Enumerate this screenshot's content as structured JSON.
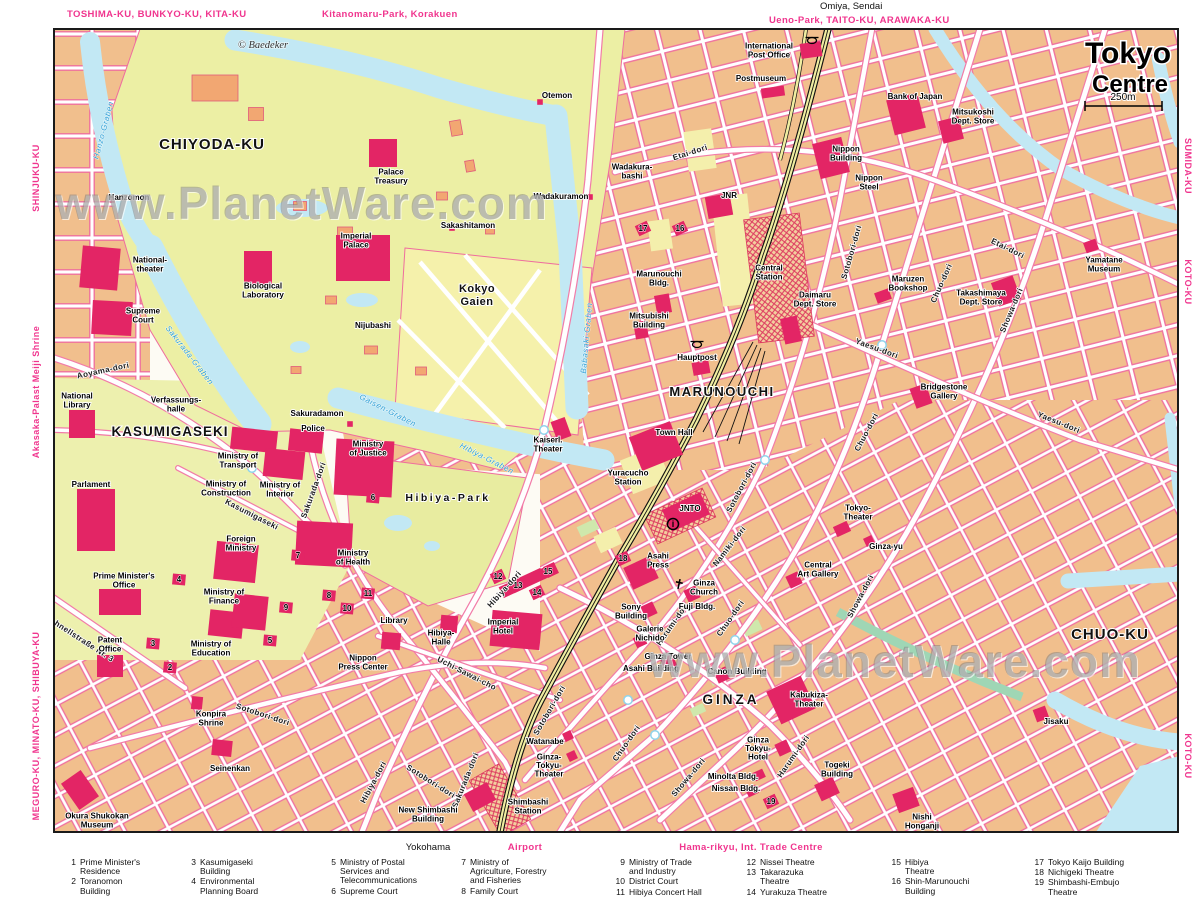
{
  "header": {
    "top_labels": [
      {
        "text": "TOSHIMA-KU, BUNKYO-KU, KITA-KU",
        "color": "pink"
      },
      {
        "text": "Kitanomaru-Park, Korakuen",
        "color": "pink"
      },
      {
        "text": "Omiya, Sendai",
        "color": "black"
      },
      {
        "text": "Ueno-Park, TAITO-KU, ARAWAKA-KU",
        "color": "pink"
      }
    ]
  },
  "title": {
    "line1": "Tokyo",
    "line2": "Centre",
    "scale_label": "250m"
  },
  "copyright": "© Baedeker",
  "watermark": {
    "text": "www.PlanetWare.com"
  },
  "edges": {
    "left": [
      {
        "text": "SHINJUKU-KU"
      },
      {
        "text": "Akasaka-Palast  Meiji Shrine"
      },
      {
        "text": "MEGURO-KU, MINATO-KU, SHIBUYA-KU"
      }
    ],
    "right": [
      {
        "text": "SUMIDA-KU"
      },
      {
        "text": "KOTO-KU"
      },
      {
        "text": "KOTO-KU"
      }
    ]
  },
  "footer": {
    "labels": [
      {
        "text": "Yokohama",
        "color": "black"
      },
      {
        "text": "Airport",
        "color": "pink"
      },
      {
        "text": "Hama-rikyu, Int. Trade Centre",
        "color": "pink"
      }
    ]
  },
  "map": {
    "districts": [
      {
        "t": "CHIYODA-KU",
        "x": 212,
        "y": 146,
        "fs": 15,
        "ls": 1
      },
      {
        "t": "KASUMIGASEKI",
        "x": 170,
        "y": 433,
        "fs": 13.5,
        "ls": 1
      },
      {
        "t": "MARUNOUCHI",
        "x": 722,
        "y": 393,
        "fs": 13,
        "ls": 1.5
      },
      {
        "t": "GINZA",
        "x": 731,
        "y": 701,
        "fs": 13.5,
        "ls": 3
      },
      {
        "t": "CHUO-KU",
        "x": 1110,
        "y": 636,
        "fs": 15,
        "ls": 1
      },
      {
        "t": "Kokyo",
        "x": 477,
        "y": 289,
        "fs": 11,
        "ls": 0.5
      },
      {
        "t": "Gaien",
        "x": 477,
        "y": 302,
        "fs": 11,
        "ls": 0.5
      },
      {
        "t": "Hibiya-Park",
        "x": 448,
        "y": 498,
        "fs": 10.5,
        "ls": 2.5
      }
    ],
    "street_labels": [
      {
        "t": "Aoyama-dori",
        "x": 103,
        "y": 370,
        "r": -12
      },
      {
        "t": "Kasumigaseki",
        "x": 252,
        "y": 514,
        "r": 27
      },
      {
        "t": "Sakurada-dori",
        "x": 313,
        "y": 490,
        "r": -70
      },
      {
        "t": "Sakurada-dori",
        "x": 465,
        "y": 780,
        "r": -68
      },
      {
        "t": "Hibiya-dori",
        "x": 504,
        "y": 589,
        "r": -48
      },
      {
        "t": "Hibiya-dori",
        "x": 373,
        "y": 782,
        "r": -62
      },
      {
        "t": "Uchi-Sawai-cho",
        "x": 467,
        "y": 673,
        "r": 27
      },
      {
        "t": "Sotobori-dori",
        "x": 851,
        "y": 252,
        "r": -74
      },
      {
        "t": "Sotobori-dori",
        "x": 741,
        "y": 487,
        "r": -62
      },
      {
        "t": "Sotobori-dori",
        "x": 263,
        "y": 714,
        "r": 18
      },
      {
        "t": "Sotobori-dori",
        "x": 431,
        "y": 781,
        "r": 32
      },
      {
        "t": "Sotobori-dori",
        "x": 549,
        "y": 710,
        "r": -60
      },
      {
        "t": "Namiki-dori",
        "x": 729,
        "y": 546,
        "r": -52
      },
      {
        "t": "Chuo-dori",
        "x": 941,
        "y": 283,
        "r": -66
      },
      {
        "t": "Chuo-dori",
        "x": 866,
        "y": 432,
        "r": -62
      },
      {
        "t": "Chuo-dori",
        "x": 730,
        "y": 618,
        "r": -55
      },
      {
        "t": "Chuo-dori",
        "x": 626,
        "y": 743,
        "r": -55
      },
      {
        "t": "Showa-dori",
        "x": 1011,
        "y": 310,
        "r": -67
      },
      {
        "t": "Showa-dori",
        "x": 860,
        "y": 596,
        "r": -62
      },
      {
        "t": "Showa-dori",
        "x": 688,
        "y": 777,
        "r": -50
      },
      {
        "t": "Harumi-dori",
        "x": 672,
        "y": 624,
        "r": -55
      },
      {
        "t": "Harumi-dori",
        "x": 793,
        "y": 756,
        "r": -55
      },
      {
        "t": "Yaesu-dori",
        "x": 877,
        "y": 348,
        "r": 20
      },
      {
        "t": "Yaesu-dori",
        "x": 1059,
        "y": 422,
        "r": 22
      },
      {
        "t": "Etai-dori",
        "x": 690,
        "y": 152,
        "r": -18
      },
      {
        "t": "Etai-dori",
        "x": 1008,
        "y": 248,
        "r": 26
      },
      {
        "t": "Schnellstraße Nr. 3",
        "x": 80,
        "y": 638,
        "r": 33
      }
    ],
    "water_labels": [
      {
        "t": "Hanzo-Graben",
        "x": 103,
        "y": 130,
        "r": -75
      },
      {
        "t": "Sakurada-Graben",
        "x": 190,
        "y": 355,
        "r": 52
      },
      {
        "t": "Babasaki-Graben",
        "x": 586,
        "y": 338,
        "r": -85
      },
      {
        "t": "Gaisen-Graben",
        "x": 388,
        "y": 410,
        "r": 27
      },
      {
        "t": "Hibiya-Graben",
        "x": 487,
        "y": 458,
        "r": 27
      }
    ],
    "landmarks": [
      {
        "x": 150,
        "y": 264,
        "l": [
          "National-",
          "theater"
        ]
      },
      {
        "x": 143,
        "y": 315,
        "l": [
          "Supreme",
          "Court"
        ]
      },
      {
        "x": 77,
        "y": 400,
        "l": [
          "National",
          "Library"
        ]
      },
      {
        "x": 176,
        "y": 404,
        "l": [
          "Verfassungs-",
          "halle"
        ]
      },
      {
        "x": 91,
        "y": 484,
        "l": [
          "Parlament"
        ]
      },
      {
        "x": 124,
        "y": 580,
        "l": [
          "Prime Minister's",
          "Office"
        ]
      },
      {
        "x": 110,
        "y": 644,
        "l": [
          "Patent",
          "Office"
        ]
      },
      {
        "x": 97,
        "y": 820,
        "l": [
          "Okura Shukokan",
          "Museum"
        ]
      },
      {
        "x": 230,
        "y": 768,
        "l": [
          "Seinenkan"
        ]
      },
      {
        "x": 211,
        "y": 718,
        "l": [
          "Konpira",
          "Shrine"
        ]
      },
      {
        "x": 211,
        "y": 648,
        "l": [
          "Ministry of",
          "Education"
        ]
      },
      {
        "x": 224,
        "y": 596,
        "l": [
          "Ministry of",
          "Finance"
        ]
      },
      {
        "x": 238,
        "y": 460,
        "l": [
          "Ministry of",
          "Transport"
        ]
      },
      {
        "x": 226,
        "y": 488,
        "l": [
          "Ministry of",
          "Construction"
        ]
      },
      {
        "x": 280,
        "y": 489,
        "l": [
          "Ministry of",
          "Interior"
        ]
      },
      {
        "x": 241,
        "y": 543,
        "l": [
          "Foreign",
          "Ministry"
        ]
      },
      {
        "x": 353,
        "y": 557,
        "l": [
          "Ministry",
          "of Health"
        ]
      },
      {
        "x": 313,
        "y": 428,
        "l": [
          "Police"
        ]
      },
      {
        "x": 368,
        "y": 448,
        "l": [
          "Ministry",
          "of Justice"
        ]
      },
      {
        "x": 394,
        "y": 620,
        "l": [
          "Library"
        ]
      },
      {
        "x": 363,
        "y": 662,
        "l": [
          "Nippon",
          "Press Center"
        ]
      },
      {
        "x": 441,
        "y": 637,
        "l": [
          "Hibiya-",
          "Halle"
        ]
      },
      {
        "x": 503,
        "y": 626,
        "l": [
          "Imperial",
          "Hotel"
        ]
      },
      {
        "x": 263,
        "y": 290,
        "l": [
          "Biological",
          "Laboratory"
        ]
      },
      {
        "x": 356,
        "y": 240,
        "l": [
          "Imperial",
          "Palace"
        ]
      },
      {
        "x": 391,
        "y": 176,
        "l": [
          "Palace",
          "Treasury"
        ]
      },
      {
        "x": 129,
        "y": 197,
        "l": [
          "Hanzomon"
        ]
      },
      {
        "x": 557,
        "y": 95,
        "l": [
          "Otemon"
        ]
      },
      {
        "x": 561,
        "y": 196,
        "l": [
          "Wadakuramon"
        ]
      },
      {
        "x": 468,
        "y": 225,
        "l": [
          "Sakashitamon"
        ]
      },
      {
        "x": 632,
        "y": 171,
        "l": [
          "Wadakura-",
          "bashi"
        ]
      },
      {
        "x": 373,
        "y": 325,
        "l": [
          "Nijubashi"
        ]
      },
      {
        "x": 317,
        "y": 413,
        "l": [
          "Sakuradamon"
        ]
      },
      {
        "x": 548,
        "y": 444,
        "l": [
          "Kaiserl.",
          "Theater"
        ]
      },
      {
        "x": 674,
        "y": 432,
        "l": [
          "Town Hall"
        ]
      },
      {
        "x": 628,
        "y": 477,
        "l": [
          "Yuracucho",
          "Station"
        ]
      },
      {
        "x": 690,
        "y": 508,
        "l": [
          "JNTO"
        ]
      },
      {
        "x": 658,
        "y": 560,
        "l": [
          "Asahi",
          "Press"
        ]
      },
      {
        "x": 704,
        "y": 587,
        "l": [
          "Ginza",
          "Church"
        ]
      },
      {
        "x": 631,
        "y": 611,
        "l": [
          "Sony",
          "Building"
        ]
      },
      {
        "x": 697,
        "y": 606,
        "l": [
          "Fuji Bldg."
        ]
      },
      {
        "x": 650,
        "y": 633,
        "l": [
          "Galerie",
          "Nichido"
        ]
      },
      {
        "x": 668,
        "y": 656,
        "l": [
          "Ginza Tower"
        ]
      },
      {
        "x": 651,
        "y": 668,
        "l": [
          "Asahi Building"
        ]
      },
      {
        "x": 737,
        "y": 671,
        "l": [
          "Canon Building"
        ]
      },
      {
        "x": 818,
        "y": 569,
        "l": [
          "Central",
          "Art Gallery"
        ]
      },
      {
        "x": 858,
        "y": 512,
        "l": [
          "Tokyo-",
          "Theater"
        ]
      },
      {
        "x": 886,
        "y": 546,
        "l": [
          "Ginza-yu"
        ]
      },
      {
        "x": 809,
        "y": 699,
        "l": [
          "Kabukiza-",
          "Theater"
        ]
      },
      {
        "x": 758,
        "y": 748,
        "l": [
          "Ginza",
          "Tokyu-",
          "Hotel"
        ]
      },
      {
        "x": 733,
        "y": 776,
        "l": [
          "Minolta Bldg."
        ]
      },
      {
        "x": 736,
        "y": 788,
        "l": [
          "Nissan Bldg."
        ]
      },
      {
        "x": 837,
        "y": 769,
        "l": [
          "Togeki",
          "Building"
        ]
      },
      {
        "x": 1056,
        "y": 721,
        "l": [
          "Jisaku"
        ]
      },
      {
        "x": 922,
        "y": 821,
        "l": [
          "Nishi",
          "Honganji"
        ]
      },
      {
        "x": 545,
        "y": 741,
        "l": [
          "Watanabe"
        ]
      },
      {
        "x": 549,
        "y": 765,
        "l": [
          "Ginza-",
          "Tokyu-",
          "Theater"
        ]
      },
      {
        "x": 528,
        "y": 806,
        "l": [
          "Shimbashi",
          "Station"
        ]
      },
      {
        "x": 428,
        "y": 814,
        "l": [
          "New Shimbashi",
          "Building"
        ]
      },
      {
        "x": 659,
        "y": 278,
        "l": [
          "Marunouchi",
          "Bldg."
        ]
      },
      {
        "x": 649,
        "y": 320,
        "l": [
          "Mitsubishi",
          "Building"
        ]
      },
      {
        "x": 697,
        "y": 357,
        "l": [
          "Hauptpost"
        ]
      },
      {
        "x": 769,
        "y": 272,
        "l": [
          "Central",
          "Station"
        ]
      },
      {
        "x": 815,
        "y": 299,
        "l": [
          "Daimaru",
          "Dept. Store"
        ]
      },
      {
        "x": 729,
        "y": 195,
        "l": [
          "JNR"
        ]
      },
      {
        "x": 908,
        "y": 283,
        "l": [
          "Maruzen",
          "Bookshop"
        ]
      },
      {
        "x": 981,
        "y": 297,
        "l": [
          "Takashimaya",
          "Dept. Store"
        ]
      },
      {
        "x": 944,
        "y": 391,
        "l": [
          "Bridgestone",
          "Gallery"
        ]
      },
      {
        "x": 1104,
        "y": 264,
        "l": [
          "Yamatane",
          "Museum"
        ]
      },
      {
        "x": 769,
        "y": 50,
        "l": [
          "International",
          "Post Office"
        ]
      },
      {
        "x": 761,
        "y": 78,
        "l": [
          "Postmuseum"
        ]
      },
      {
        "x": 915,
        "y": 96,
        "l": [
          "Bank of Japan"
        ]
      },
      {
        "x": 973,
        "y": 116,
        "l": [
          "Mitsukoshi",
          "Dept. Store"
        ]
      },
      {
        "x": 846,
        "y": 153,
        "l": [
          "Nippon",
          "Building"
        ]
      },
      {
        "x": 869,
        "y": 182,
        "l": [
          "Nippon",
          "Steel"
        ]
      }
    ],
    "numbered_markers": [
      {
        "n": "1",
        "x": 46,
        "y": 592
      },
      {
        "n": "2",
        "x": 170,
        "y": 667
      },
      {
        "n": "3",
        "x": 153,
        "y": 643
      },
      {
        "n": "4",
        "x": 179,
        "y": 579
      },
      {
        "n": "5",
        "x": 270,
        "y": 640
      },
      {
        "n": "6",
        "x": 373,
        "y": 497
      },
      {
        "n": "7",
        "x": 298,
        "y": 555
      },
      {
        "n": "8",
        "x": 329,
        "y": 595
      },
      {
        "n": "9",
        "x": 286,
        "y": 607
      },
      {
        "n": "10",
        "x": 347,
        "y": 608
      },
      {
        "n": "11",
        "x": 368,
        "y": 593
      },
      {
        "n": "12",
        "x": 498,
        "y": 576
      },
      {
        "n": "13",
        "x": 518,
        "y": 585
      },
      {
        "n": "14",
        "x": 537,
        "y": 592
      },
      {
        "n": "15",
        "x": 548,
        "y": 571
      },
      {
        "n": "16",
        "x": 680,
        "y": 228
      },
      {
        "n": "17",
        "x": 643,
        "y": 228
      },
      {
        "n": "18",
        "x": 623,
        "y": 558
      },
      {
        "n": "19",
        "x": 771,
        "y": 801
      }
    ],
    "icons": [
      {
        "type": "post-horn-icon",
        "x": 697,
        "y": 344
      },
      {
        "type": "post-horn-icon",
        "x": 812,
        "y": 40
      },
      {
        "type": "info-icon",
        "x": 673,
        "y": 524
      },
      {
        "type": "church-cross-icon",
        "x": 679,
        "y": 584
      }
    ]
  },
  "legend": {
    "columns": [
      [
        {
          "n": "1",
          "t": "Prime Minister's\nResidence"
        },
        {
          "n": "2",
          "t": "Toranomon\nBuilding"
        }
      ],
      [
        {
          "n": "3",
          "t": "Kasumigaseki\nBuilding"
        },
        {
          "n": "4",
          "t": "Environmental\nPlanning Board"
        }
      ],
      [
        {
          "n": "5",
          "t": "Ministry of Postal\nServices and\nTelecommunications"
        },
        {
          "n": "6",
          "t": "Supreme Court"
        }
      ],
      [
        {
          "n": "7",
          "t": "Ministry of\nAgriculture, Forestry\nand Fisheries"
        },
        {
          "n": "8",
          "t": "Family Court"
        }
      ],
      [
        {
          "n": "9",
          "t": "Ministry of Trade\nand Industry"
        },
        {
          "n": "10",
          "t": "District Court"
        },
        {
          "n": "11",
          "t": "Hibiya Concert Hall"
        }
      ],
      [
        {
          "n": "12",
          "t": "Nissei Theatre"
        },
        {
          "n": "13",
          "t": "Takarazuka\nTheatre"
        },
        {
          "n": "14",
          "t": "Yurakuza Theatre"
        }
      ],
      [
        {
          "n": "15",
          "t": "Hibiya\nTheatre"
        },
        {
          "n": "16",
          "t": "Shin-Marunouchi\nBuilding"
        }
      ],
      [
        {
          "n": "17",
          "t": "Tokyo Kaijo Building"
        },
        {
          "n": "18",
          "t": "Nichigeki Theatre"
        },
        {
          "n": "19",
          "t": "Shimbashi-Embujo\nTheatre"
        }
      ]
    ]
  },
  "colors": {
    "accent_pink": "#f0358e",
    "building_red": "#e32565",
    "water_blue": "#c2e8f4",
    "park_green": "#ecefa4",
    "block_tan": "#f1bf8d",
    "railway_yellow": "#f0eda0"
  }
}
